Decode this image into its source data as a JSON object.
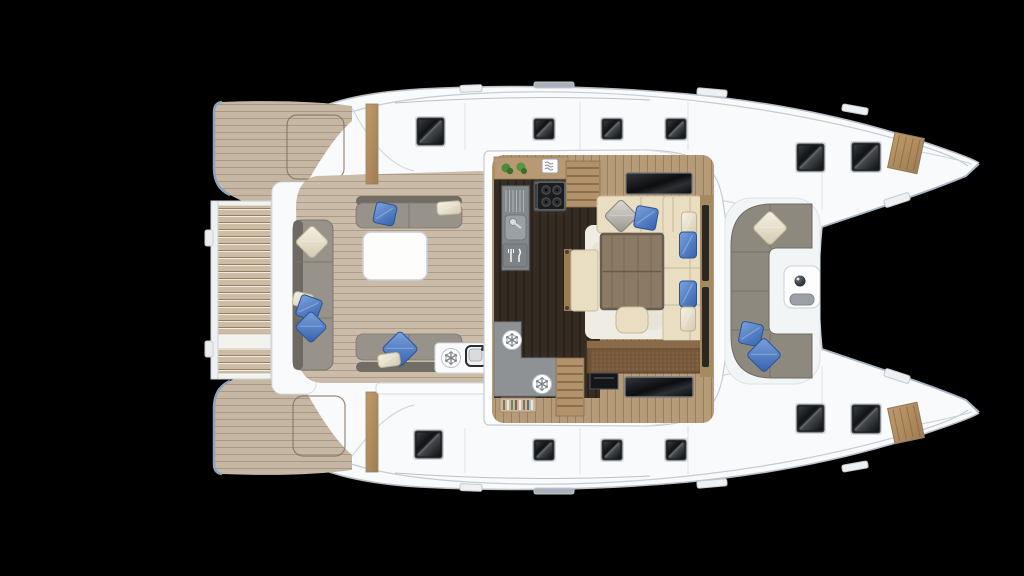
{
  "scene": {
    "type": "catamaran-deck-floorplan-top-view",
    "background": "#000000"
  },
  "colors": {
    "bg": "#000000",
    "hull": "#f8fafb",
    "hullLine": "#b7bfc7",
    "sheerLine": "#c6ccd3",
    "bluegrayEdge": "#8fa3bd",
    "teakDeck": "#c6b7a5",
    "teakPlank": "#9a8871",
    "cockpitTeak": "#cbbcaa",
    "slatWood": "#cdbba2",
    "galleyFloor": "#352c24",
    "saloonWood": "#b59b78",
    "cabinetWood": "#b79a73",
    "stairWood": "#b1926a",
    "counterGray": "#8f9294",
    "sinkGray": "#83888c",
    "benchGray": "#98938a",
    "benchBack": "#716c64",
    "sofaGray": "#8e897f",
    "cushionCream": "#e9ddc2",
    "cushionSeam": "#c9b896",
    "pillowBlue": "#4679c8",
    "pillowCream": "#efe9d8",
    "pillowGray": "#c2c0ba",
    "rug": "#efece3",
    "tableWood": "#8b7b64",
    "tableFrame": "#675c4f",
    "sideboard": "#6e5336",
    "tvBlack": "#121416",
    "plantGreen": "#4e8a3a"
  },
  "icons": {
    "fridge": "snowflake-in-circle",
    "galley_sink": "sink-faucet",
    "cockpit_sink": "sink-faucet",
    "dishwasher": "fork-knife",
    "microwave": "wavy-lines-box",
    "stove": "four-burner-hob",
    "plants": "two-green-plants"
  },
  "hatches": {
    "style": "black-glass-rounded-square",
    "deck_top": [
      {
        "x": 418,
        "y": 119,
        "s": 25
      },
      {
        "x": 535,
        "y": 120,
        "s": 18
      },
      {
        "x": 603,
        "y": 120,
        "s": 18
      },
      {
        "x": 667,
        "y": 120,
        "s": 18
      },
      {
        "x": 798,
        "y": 145,
        "s": 25
      },
      {
        "x": 853,
        "y": 144,
        "s": 26
      }
    ],
    "deck_bottom": [
      {
        "x": 416,
        "y": 432,
        "s": 25
      },
      {
        "x": 535,
        "y": 441,
        "s": 18
      },
      {
        "x": 603,
        "y": 441,
        "s": 18
      },
      {
        "x": 667,
        "y": 441,
        "s": 18
      },
      {
        "x": 798,
        "y": 406,
        "s": 25
      },
      {
        "x": 853,
        "y": 406,
        "s": 26
      }
    ]
  },
  "pillows": [
    {
      "cx": 312,
      "cy": 242,
      "w": 24,
      "h": 24,
      "rot": 45,
      "color": "cream",
      "where": "aft-bench"
    },
    {
      "cx": 303,
      "cy": 300,
      "w": 20,
      "h": 14,
      "rot": 12,
      "color": "cream",
      "where": "aft-bench"
    },
    {
      "cx": 309,
      "cy": 308,
      "w": 22,
      "h": 22,
      "rot": 20,
      "color": "blue",
      "where": "aft-bench"
    },
    {
      "cx": 311,
      "cy": 327,
      "w": 23,
      "h": 23,
      "rot": 45,
      "color": "blue",
      "where": "aft-bench"
    },
    {
      "cx": 385,
      "cy": 214,
      "w": 21,
      "h": 21,
      "rot": 12,
      "color": "blue",
      "where": "cockpit-port-bench"
    },
    {
      "cx": 449,
      "cy": 208,
      "w": 24,
      "h": 13,
      "rot": -4,
      "color": "cream",
      "where": "cockpit-port-bench"
    },
    {
      "cx": 400,
      "cy": 349,
      "w": 26,
      "h": 26,
      "rot": 45,
      "color": "blue",
      "where": "cockpit-stbd-bench"
    },
    {
      "cx": 389,
      "cy": 360,
      "w": 22,
      "h": 13,
      "rot": -8,
      "color": "cream",
      "where": "cockpit-stbd-bench"
    },
    {
      "cx": 621,
      "cy": 216,
      "w": 24,
      "h": 24,
      "rot": 45,
      "color": "gray",
      "where": "dining-sofa"
    },
    {
      "cx": 646,
      "cy": 218,
      "w": 22,
      "h": 22,
      "rot": 10,
      "color": "blue",
      "where": "dining-sofa"
    },
    {
      "cx": 689,
      "cy": 224,
      "w": 15,
      "h": 24,
      "rot": 0,
      "color": "cream",
      "where": "dining-sofa"
    },
    {
      "cx": 688,
      "cy": 245,
      "w": 17,
      "h": 26,
      "rot": 0,
      "color": "blue",
      "where": "dining-sofa"
    },
    {
      "cx": 688,
      "cy": 294,
      "w": 17,
      "h": 26,
      "rot": 0,
      "color": "blue",
      "where": "dining-sofa"
    },
    {
      "cx": 688,
      "cy": 319,
      "w": 15,
      "h": 24,
      "rot": 0,
      "color": "cream",
      "where": "dining-sofa"
    },
    {
      "cx": 770,
      "cy": 228,
      "w": 25,
      "h": 25,
      "rot": 45,
      "color": "cream",
      "where": "foredeck-sofa"
    },
    {
      "cx": 751,
      "cy": 334,
      "w": 22,
      "h": 22,
      "rot": 12,
      "color": "blue",
      "where": "foredeck-sofa"
    },
    {
      "cx": 764,
      "cy": 355,
      "w": 25,
      "h": 25,
      "rot": 45,
      "color": "blue",
      "where": "foredeck-sofa"
    }
  ],
  "fridge_icons": [
    {
      "cx": 512,
      "cy": 340,
      "where": "galley-counter"
    },
    {
      "cx": 542,
      "cy": 384,
      "where": "galley-counter"
    },
    {
      "cx": 451,
      "cy": 358,
      "where": "cockpit-wetbar"
    }
  ],
  "deck_fittings": [
    {
      "x": 460,
      "y": 85,
      "w": 22,
      "h": 7,
      "rot": -2,
      "tone": "light"
    },
    {
      "x": 534,
      "y": 82,
      "w": 40,
      "h": 6,
      "rot": 0,
      "tone": "dark"
    },
    {
      "x": 697,
      "y": 89,
      "w": 30,
      "h": 7,
      "rot": 5,
      "tone": "light"
    },
    {
      "x": 842,
      "y": 106,
      "w": 26,
      "h": 7,
      "rot": 10,
      "tone": "light"
    },
    {
      "x": 884,
      "y": 196,
      "w": 26,
      "h": 8,
      "rot": -18,
      "tone": "light"
    },
    {
      "x": 460,
      "y": 484,
      "w": 22,
      "h": 7,
      "rot": 2,
      "tone": "light"
    },
    {
      "x": 534,
      "y": 488,
      "w": 40,
      "h": 6,
      "rot": 0,
      "tone": "dark"
    },
    {
      "x": 697,
      "y": 480,
      "w": 30,
      "h": 7,
      "rot": -5,
      "tone": "light"
    },
    {
      "x": 842,
      "y": 463,
      "w": 26,
      "h": 7,
      "rot": -10,
      "tone": "light"
    },
    {
      "x": 884,
      "y": 372,
      "w": 26,
      "h": 8,
      "rot": 18,
      "tone": "light"
    }
  ],
  "furniture": {
    "swim_platform": "teak-slatted-lift-platform",
    "aft_teak_decks": 2,
    "cockpit": [
      "aft-bench",
      "port-bench",
      "starboard-bench",
      "white-table",
      "wet-bar-fridge-sink"
    ],
    "saloon": [
      "galley-counter-plants",
      "microwave",
      "stove-4-burner",
      "sink-dishwasher-column",
      "stairs-port",
      "tv-forward",
      "u-shaped-dining-sofa",
      "dining-table",
      "rug",
      "ottoman",
      "side-bench",
      "aft-l-counter-2-fridges",
      "wine-rack",
      "stairs-starboard",
      "aft-sideboard",
      "tv-aft",
      "front-window-blinds"
    ],
    "foredeck": [
      "c-shaped-sofa",
      "console-table",
      "trampoline-opening",
      "2-deck-hatches",
      "teak-bow-hatch"
    ]
  }
}
